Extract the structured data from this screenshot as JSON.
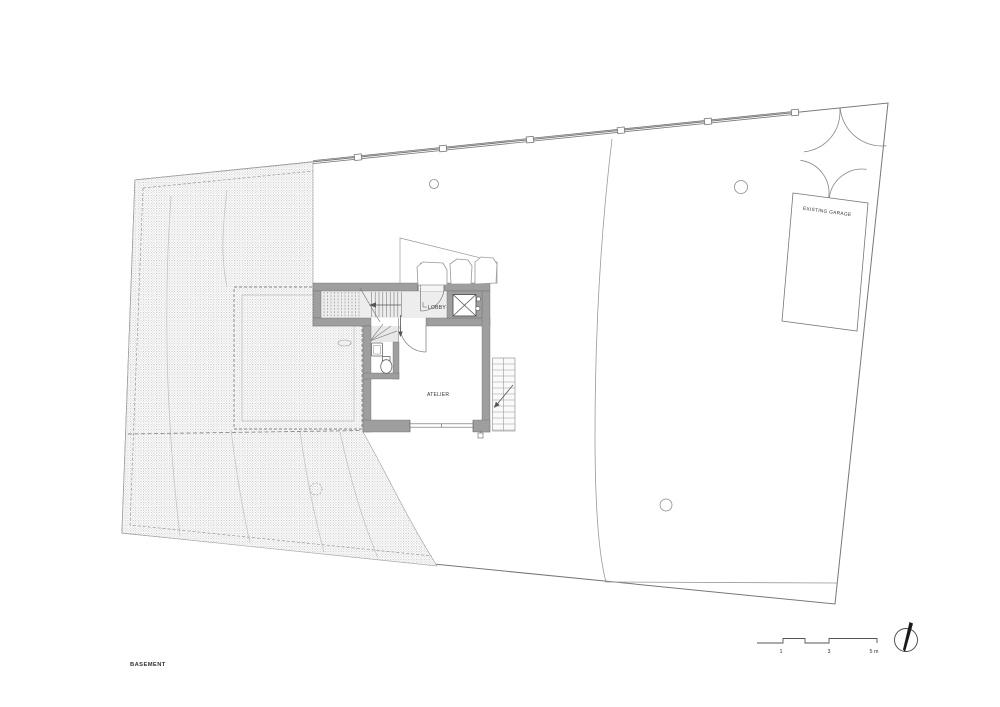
{
  "plan": {
    "floor_label": "BASEMENT",
    "room_labels": {
      "lobby": "LOBBY",
      "atelier": "ATELIER"
    },
    "garage_label": "EXISTING GARAGE",
    "scale_bar": {
      "ticks": [
        "1",
        "3",
        "5 m"
      ]
    },
    "icons": {
      "north": "north-arrow-icon",
      "elevator": "elevator-x-icon",
      "stairs": "stair-direction-arrow-icon"
    },
    "colors": {
      "paper": "#ffffff",
      "wall_fill": "#9e9e9e",
      "corridor_floor": "#ededed",
      "hatch_dot": "#bcbcbc",
      "line": "#777777",
      "text": "#333333"
    }
  }
}
